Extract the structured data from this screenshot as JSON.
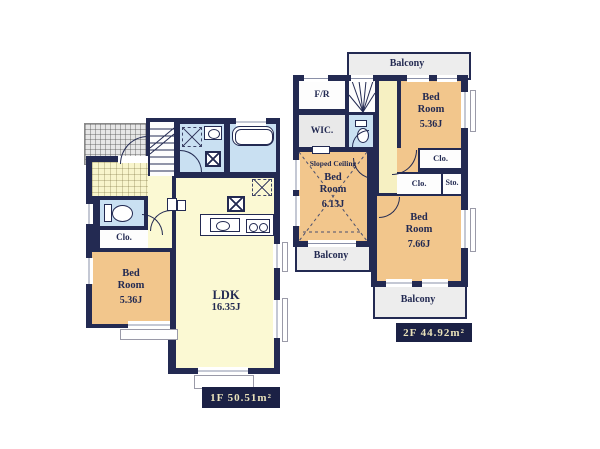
{
  "colors": {
    "wall": "#232a52",
    "bedroom_tan": "#f2c68c",
    "living_pale_yellow": "#fbf9d3",
    "hall_cream": "#f6f0c2",
    "wet_area_blue": "#c9e0f2",
    "balcony_gray": "#ededed",
    "area_label_bg": "#1b2145",
    "area_label_fg": "#e9e2ba"
  },
  "floor1": {
    "area_label": "1F 50.51m²",
    "bedroom": {
      "name": "Bed Room",
      "size": "5.36J"
    },
    "ldk": {
      "name": "LDK",
      "size": "16.35J"
    },
    "closet": "Clo."
  },
  "floor2": {
    "area_label": "2F 44.92m²",
    "free_room": "F/R",
    "wic": "WIC.",
    "bedroom_ne": {
      "name": "Bed Room",
      "size": "5.36J"
    },
    "bedroom_w": {
      "name": "Bed Room",
      "size": "6.13J",
      "note": "Sloped Ceiling"
    },
    "bedroom_se": {
      "name": "Bed Room",
      "size": "7.66J"
    },
    "closet_ne": "Clo.",
    "closet_se": "Clo.",
    "storage": "Sto.",
    "balcony_top": "Balcony",
    "balcony_left": "Balcony",
    "balcony_bottom": "Balcony"
  }
}
